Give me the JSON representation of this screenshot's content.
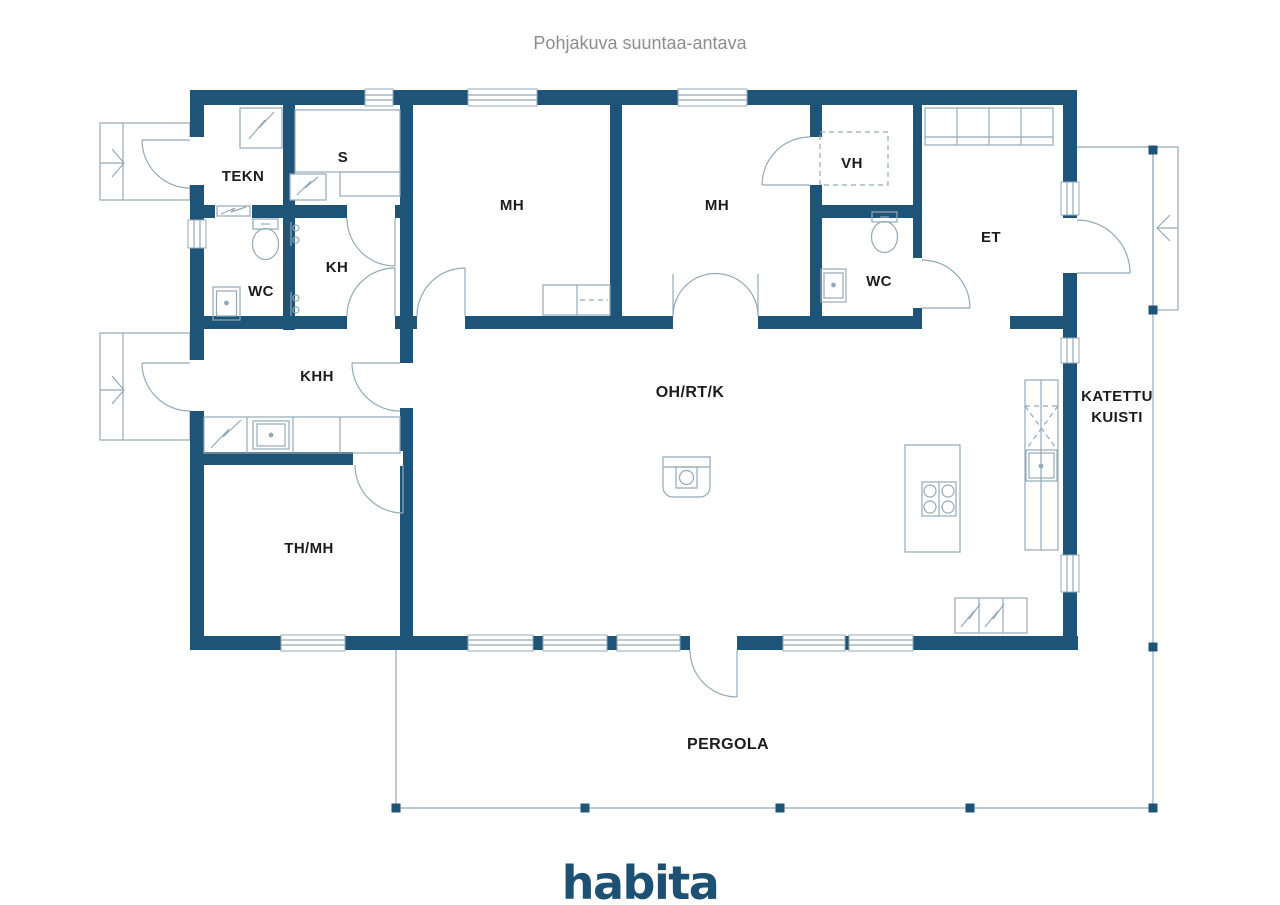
{
  "title": "Pohjakuva suuntaa-antava",
  "logo": "habita",
  "rooms": {
    "tekn": "TEKN",
    "sauna": "S",
    "wc_left": "WC",
    "kh": "KH",
    "khh": "KHH",
    "mh_left": "MH",
    "mh_right": "MH",
    "vh": "VH",
    "wc_right": "WC",
    "et": "ET",
    "living": "OH/RT/K",
    "th_mh": "TH/MH",
    "kuisti_line1": "KATETTU",
    "kuisti_line2": "KUISTI",
    "pergola": "PERGOLA"
  },
  "colors": {
    "wall": "#1e5478",
    "line": "#94a9b7",
    "label": "#1c1c1c",
    "title": "#8d8d8d",
    "logo": "#1d5174"
  }
}
